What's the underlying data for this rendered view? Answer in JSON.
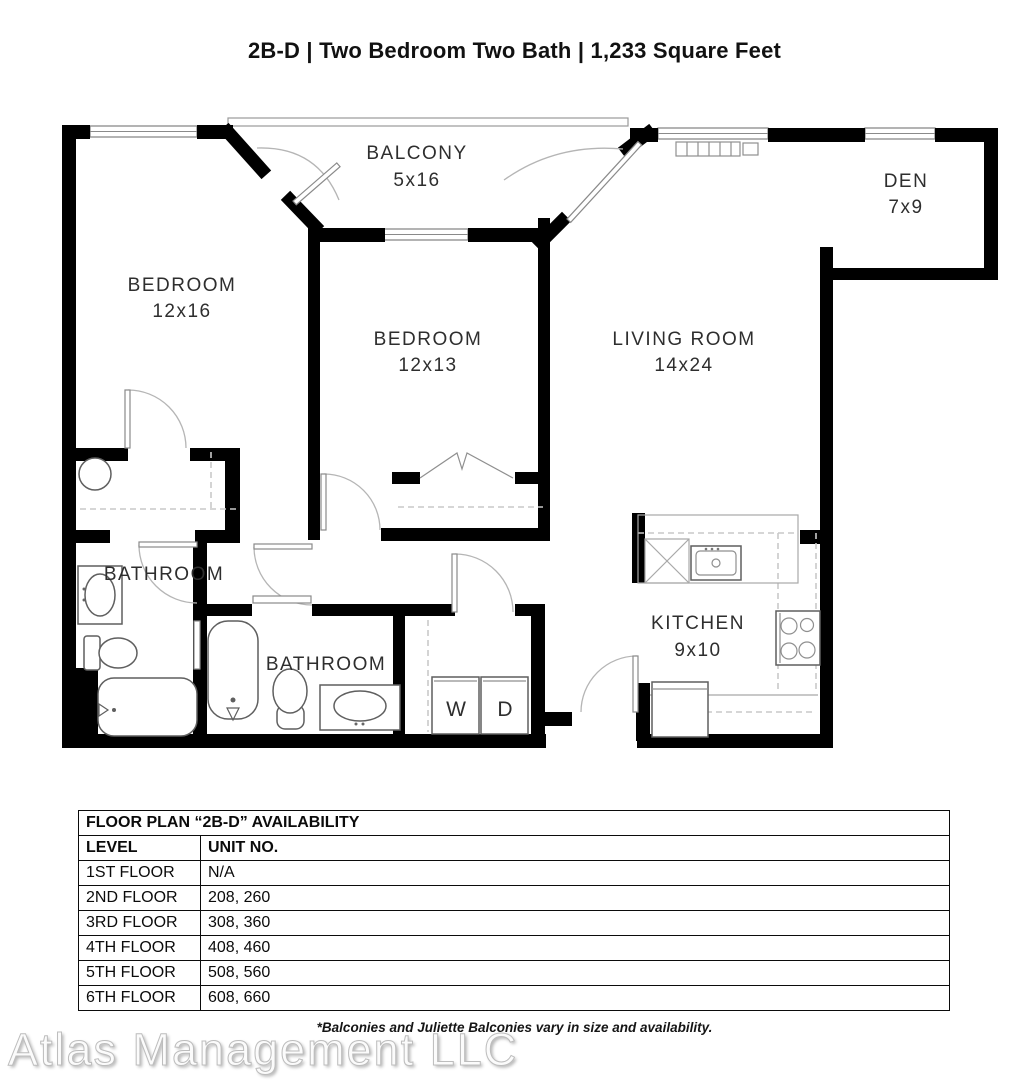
{
  "title": "2B-D | Two Bedroom Two Bath | 1,233 Square Feet",
  "floor_plan": {
    "rooms": {
      "balcony": {
        "name": "BALCONY",
        "dims": "5x16"
      },
      "den": {
        "name": "DEN",
        "dims": "7x9"
      },
      "bedroom1": {
        "name": "BEDROOM",
        "dims": "12x16"
      },
      "bedroom2": {
        "name": "BEDROOM",
        "dims": "12x13"
      },
      "living": {
        "name": "LIVING ROOM",
        "dims": "14x24"
      },
      "kitchen": {
        "name": "KITCHEN",
        "dims": "9x10"
      },
      "bathroom1": {
        "name": "BATHROOM"
      },
      "bathroom2": {
        "name": "BATHROOM"
      },
      "washer": "W",
      "dryer": "D"
    }
  },
  "availability_table": {
    "title": "FLOOR PLAN “2B-D” AVAILABILITY",
    "columns": [
      "LEVEL",
      "UNIT NO."
    ],
    "rows": [
      {
        "level": "1ST FLOOR",
        "units": "N/A"
      },
      {
        "level": "2ND FLOOR",
        "units": "208, 260"
      },
      {
        "level": "3RD FLOOR",
        "units": "308, 360"
      },
      {
        "level": "4TH FLOOR",
        "units": "408, 460"
      },
      {
        "level": "5TH FLOOR",
        "units": "508, 560"
      },
      {
        "level": "6TH FLOOR",
        "units": "608, 660"
      }
    ]
  },
  "footnote": "*Balconies and Juliette Balconies vary in size and availability.",
  "watermark": "Atlas Management LLC",
  "colors": {
    "wall": "#000000",
    "fixture": "#5f5f5f",
    "text": "#2e2e2e",
    "watermark": "#bdbdbd"
  }
}
